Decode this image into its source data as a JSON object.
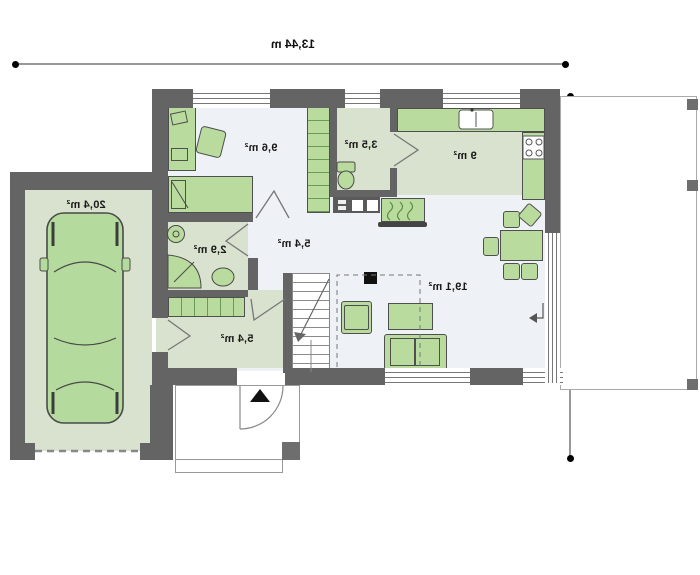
{
  "palette": {
    "wall": "#646464",
    "floor_light": "#eef1f6",
    "floor_green": "#d9e2ce",
    "furniture_green": "#b9dc9e",
    "outline": "#4f4f4f",
    "dimension_line": "#999999",
    "text": "#1a1a1a"
  },
  "dimensions": {
    "width_label": "13,44 m",
    "depth_label": "8,94 m"
  },
  "rooms": [
    {
      "name": "garage",
      "area_label": "20,4 m²"
    },
    {
      "name": "bedroom",
      "area_label": "9,6 m²"
    },
    {
      "name": "wc",
      "area_label": "3,5 m²"
    },
    {
      "name": "kitchen",
      "area_label": "9 m²"
    },
    {
      "name": "bathroom",
      "area_label": "2,9 m²"
    },
    {
      "name": "hallway",
      "area_label": "5,4 m²"
    },
    {
      "name": "entry",
      "area_label": "5,4 m²"
    },
    {
      "name": "living-room",
      "area_label": "19,1 m²"
    }
  ]
}
